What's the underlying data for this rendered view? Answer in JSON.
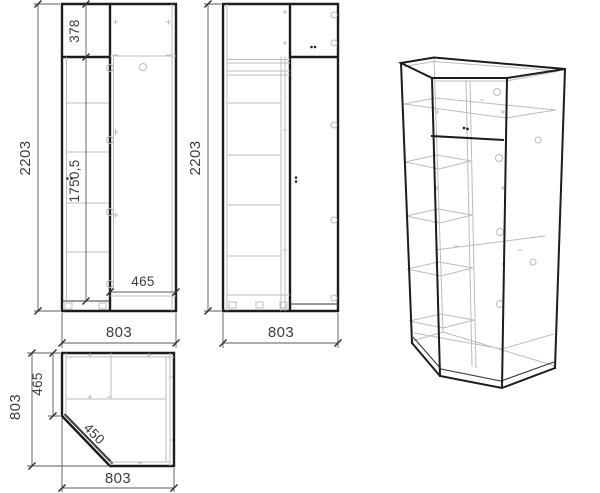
{
  "app": {
    "title": "Corner wardrobe technical drawing"
  },
  "colors": {
    "background": "#ffffff",
    "line_dark": "#1c1c1c",
    "line_light": "#bcbcbc",
    "dimension_text": "#3d3d3d"
  },
  "views": {
    "left_elevation": {
      "dims": {
        "overall_height": "2203",
        "top_section_height": "378",
        "lower_section_height": "1750,5",
        "right_section_width": "465",
        "overall_width": "803"
      }
    },
    "middle_elevation": {
      "dims": {
        "overall_height": "2203",
        "overall_width": "803"
      }
    },
    "plan": {
      "dims": {
        "overall_depth": "803",
        "left_side_depth": "465",
        "door_width": "450",
        "overall_width": "803"
      }
    }
  }
}
